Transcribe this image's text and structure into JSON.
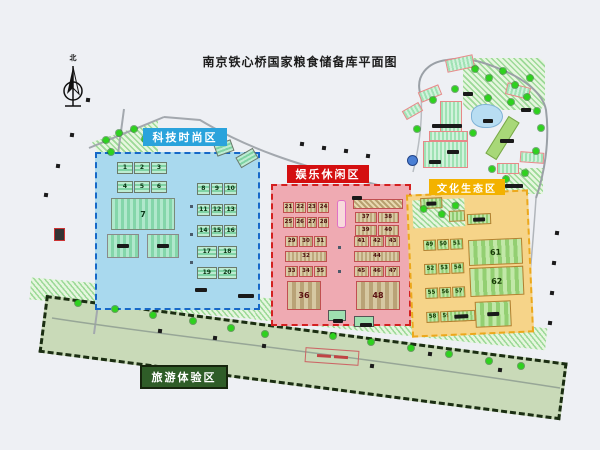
{
  "title": "南京铁心桥国家粮食储备库平面图",
  "compass": {
    "north_label": "北"
  },
  "colors": {
    "tech_fill": "#a9d9ee",
    "tech_border": "#1668c8",
    "tech_label_bg": "#2aa3dc",
    "fun_fill": "#efaab2",
    "fun_border": "#d42020",
    "fun_label_bg": "#d40f10",
    "culture_fill": "#f6d489",
    "culture_border": "#eca81c",
    "culture_label_bg": "#f3b200",
    "tour_fill": "#c9dab8",
    "tour_border": "#1b2e12",
    "tour_label_bg": "#2f5d28",
    "tree": "#2ed21e",
    "pond": "#b8ddf2",
    "road": "#a3a8ae"
  },
  "zones": {
    "tech": {
      "label": "科技时尚区",
      "buildings": {
        "left_rows": [
          [
            "1",
            "2",
            "3"
          ],
          [
            "4",
            "5",
            "6"
          ]
        ],
        "main": "7",
        "right_rows": [
          [
            "8",
            "9",
            "10"
          ],
          [
            "11",
            "12",
            "13"
          ],
          [
            "14",
            "15",
            "16"
          ],
          [
            "17",
            "18"
          ],
          [
            "19",
            "20"
          ]
        ]
      }
    },
    "fun": {
      "label": "娱乐休闲区",
      "buildings": {
        "left_top": [
          [
            "21",
            "22",
            "23",
            "24"
          ],
          [
            "25",
            "26",
            "27",
            "28"
          ]
        ],
        "left_mid": [
          [
            "29",
            "30",
            "31"
          ],
          [
            "32"
          ],
          [
            "33",
            "34",
            "35"
          ]
        ],
        "left_main": "36",
        "right_top": [
          [
            "37",
            "38"
          ],
          [
            "39",
            "40"
          ]
        ],
        "right_mid": [
          [
            "41",
            "42",
            "43"
          ],
          [
            "44"
          ],
          [
            "45",
            "46",
            "47"
          ]
        ],
        "right_main": "48"
      }
    },
    "culture": {
      "label": "文化生态区",
      "buildings": {
        "rows": [
          [
            "49",
            "50",
            "51"
          ],
          [
            "52",
            "53",
            "54"
          ],
          [
            "55",
            "56",
            "57"
          ],
          [
            "58",
            "59",
            "60"
          ]
        ],
        "main_pair": [
          "61",
          "62"
        ]
      }
    },
    "tour": {
      "label": "旅游体验区"
    }
  }
}
